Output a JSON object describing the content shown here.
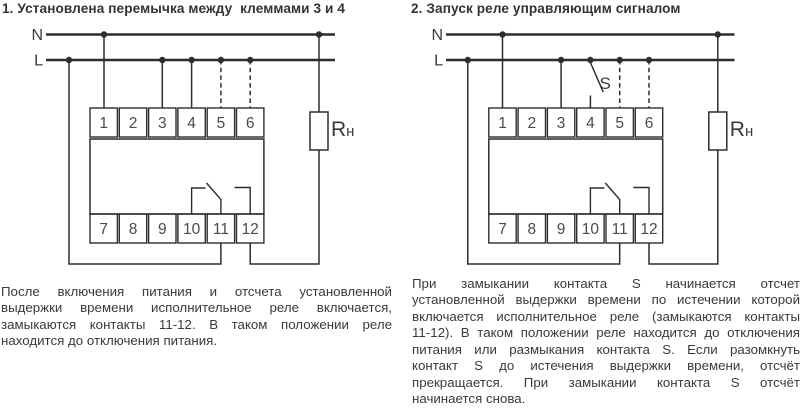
{
  "colors": {
    "ink": "#3a3a3a",
    "line": "#2d2d2d",
    "background": "#ffffff"
  },
  "d1": {
    "title": "1. Установлена перемычка между  клеммами 3 и 4",
    "n_label": "N",
    "l_label": "L",
    "load_r": "R",
    "load_sub": "н",
    "top_terminals": [
      "1",
      "2",
      "3",
      "4",
      "5",
      "6"
    ],
    "bottom_terminals": [
      "7",
      "8",
      "9",
      "10",
      "11",
      "12"
    ],
    "description_lines": [
      "После включения питания и отсчета установленной",
      "выдержки времени исполнительное реле включается,",
      "замыкаются контакты 11-12. В таком положении реле",
      "находится до отключения питания."
    ]
  },
  "d2": {
    "title": "2. Запуск реле управляющим сигналом",
    "n_label": "N",
    "l_label": "L",
    "switch_label": "S",
    "load_r": "R",
    "load_sub": "н",
    "top_terminals": [
      "1",
      "2",
      "3",
      "4",
      "5",
      "6"
    ],
    "bottom_terminals": [
      "7",
      "8",
      "9",
      "10",
      "11",
      "12"
    ],
    "description_lines": [
      "При замыкании контакта S начинается отсчет",
      "установленной выдержки времени по истечении которой",
      "включается исполнительное реле (замыкаются контакты",
      "11-12). В таком положении реле находится до отключения",
      "питания или размыкания контакта S. Если разомкнуть",
      "контакт S до истечения выдержки времени, отсчёт",
      "прекращается. При замыкании контакта S отсчёт",
      "начинается снова."
    ]
  }
}
